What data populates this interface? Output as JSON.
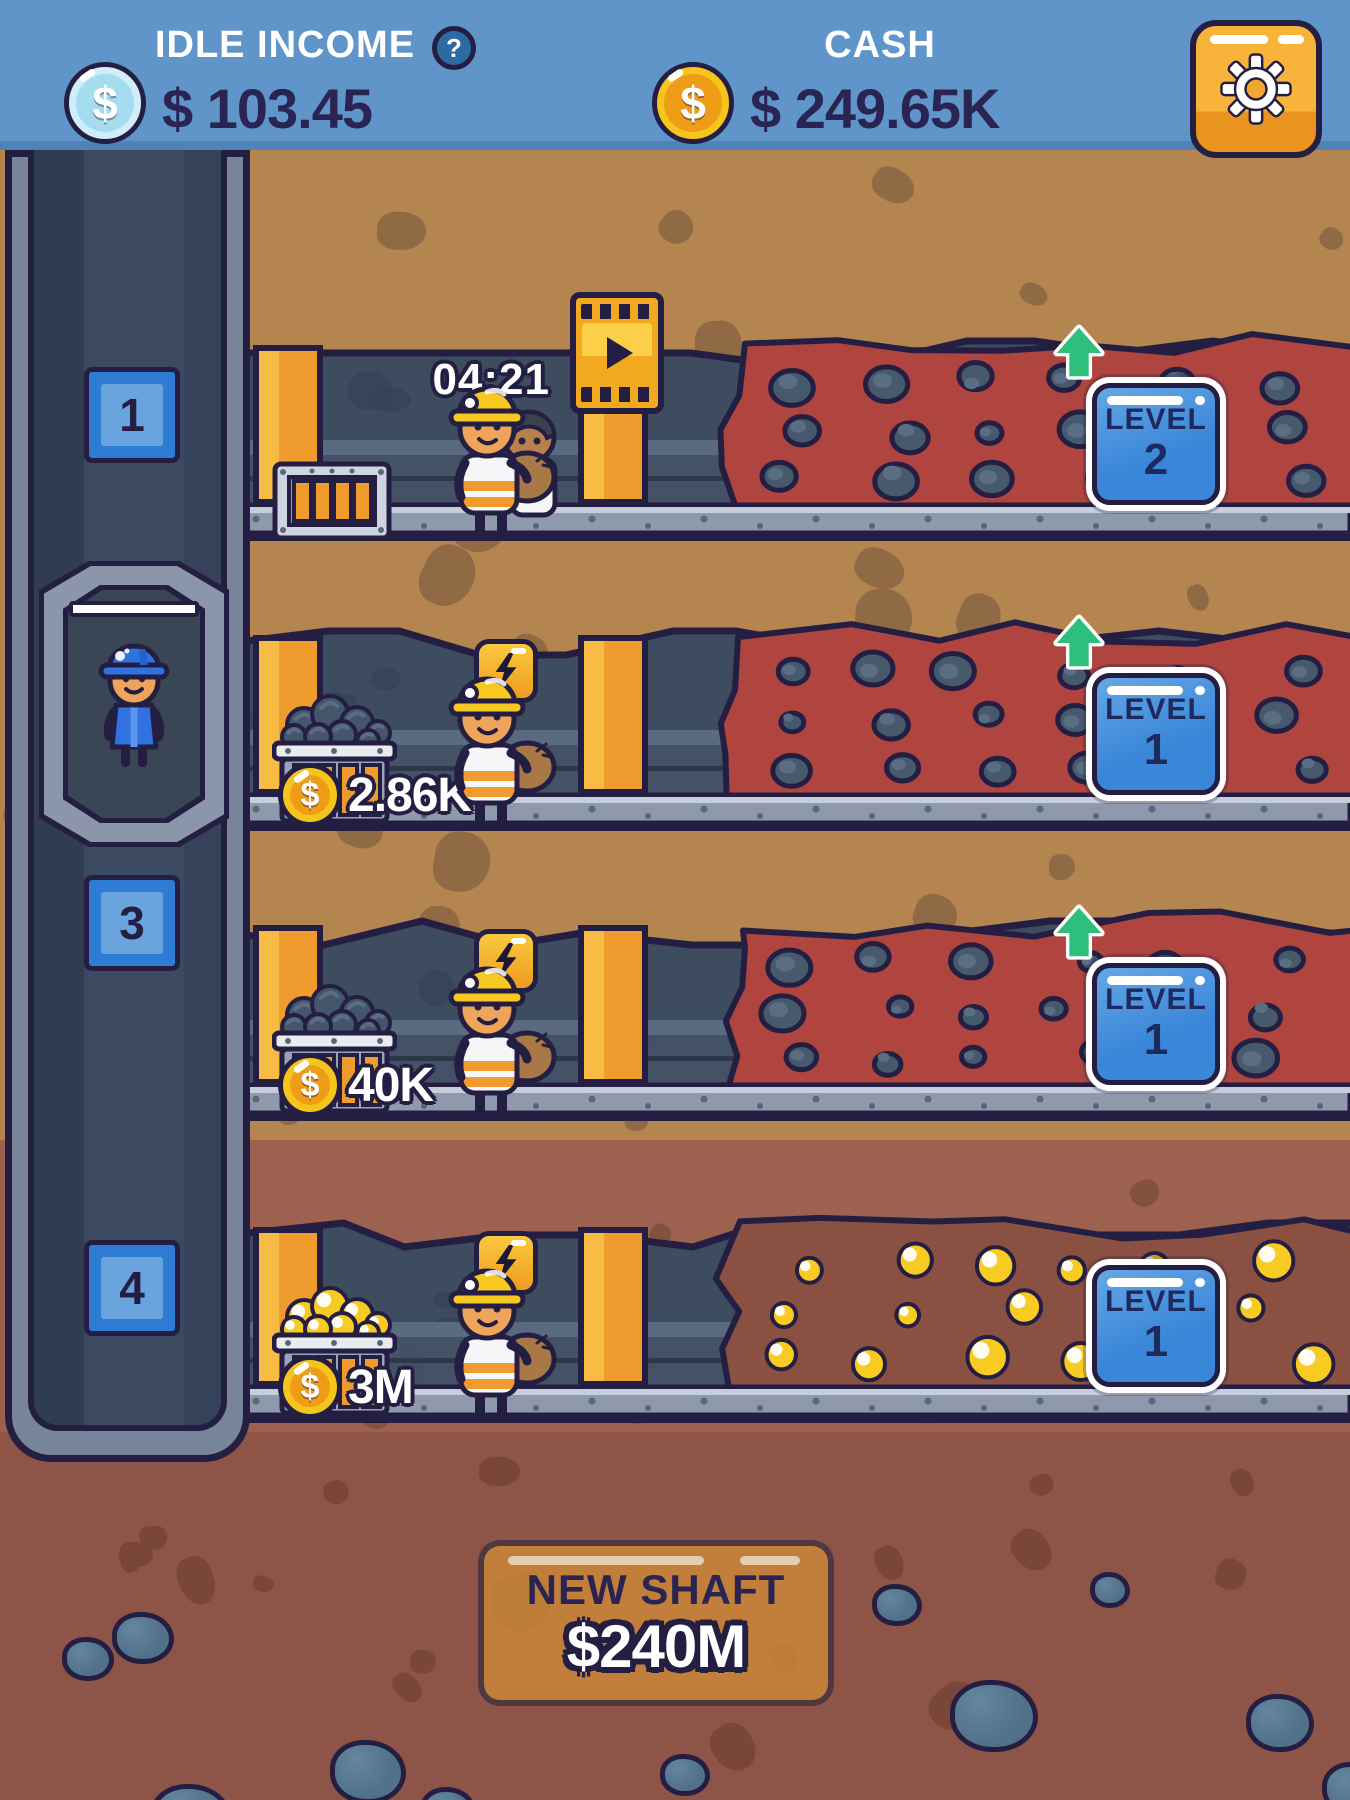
{
  "header": {
    "idle_income_label": "IDLE INCOME",
    "help_glyph": "?",
    "idle_income_value": "$ 103.45",
    "cash_label": "CASH",
    "cash_value": "$ 249.65K"
  },
  "coin": {
    "symbol": "$"
  },
  "elevator": {
    "badges": [
      "1",
      "3",
      "4"
    ]
  },
  "shafts": [
    {
      "timer": "04:21",
      "level_label": "LEVEL",
      "level_value": "2"
    },
    {
      "cart_value": "2.86K",
      "level_label": "LEVEL",
      "level_value": "1"
    },
    {
      "cart_value": "40K",
      "level_label": "LEVEL",
      "level_value": "1"
    },
    {
      "cart_value": "3M",
      "level_label": "LEVEL",
      "level_value": "1"
    }
  ],
  "footer": {
    "new_shaft_label": "NEW SHAFT",
    "new_shaft_cost": "$240M"
  },
  "colors": {
    "header_blue": "#6095ca",
    "outline_navy": "#241f42",
    "dirt_tan": "#b5854f",
    "ore_red": "#b04540",
    "gold_accent": "#f6c51d",
    "upgrade_green": "#2fbf7d",
    "button_blue": "#3a86d8"
  }
}
